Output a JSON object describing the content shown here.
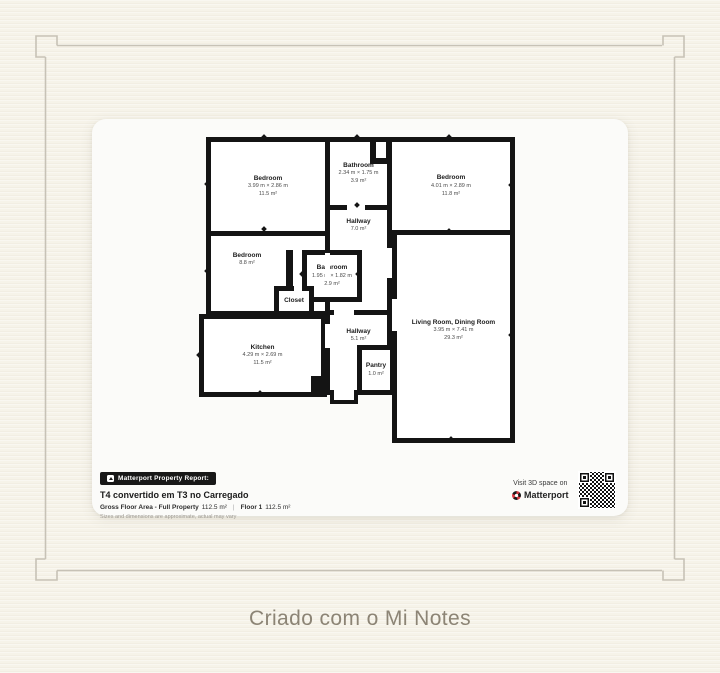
{
  "colors": {
    "background": "#f6f3e9",
    "card": "#fbfbf9",
    "wall": "#141414",
    "frame_line": "#c7c2b6",
    "matterport_red": "#d93a43",
    "footer_text": "#8c8475"
  },
  "floorplan": {
    "rooms": [
      {
        "id": "bedroom-tl",
        "name": "Bedroom",
        "dims": "3.99 m × 2.86 m",
        "area": "11.5 m²"
      },
      {
        "id": "bathroom-top",
        "name": "Bathroom",
        "dims": "2.34 m × 1.75 m",
        "area": "3.9 m²"
      },
      {
        "id": "bedroom-tr",
        "name": "Bedroom",
        "dims": "4.01 m × 2.89 m",
        "area": "11.8 m²"
      },
      {
        "id": "hallway-top",
        "name": "Hallway",
        "area": "7.0 m²"
      },
      {
        "id": "bedroom-left",
        "name": "Bedroom",
        "area": "8.8 m²"
      },
      {
        "id": "bathroom-mid",
        "name": "Bathroom",
        "dims": "1.95 m × 1.82 m",
        "area": "2.9 m²"
      },
      {
        "id": "closet",
        "name": "Closet"
      },
      {
        "id": "kitchen",
        "name": "Kitchen",
        "dims": "4.29 m × 2.69 m",
        "area": "11.5 m²"
      },
      {
        "id": "hallway-bottom",
        "name": "Hallway",
        "area": "5.1 m²"
      },
      {
        "id": "pantry",
        "name": "Pantry",
        "area": "1.0 m²"
      },
      {
        "id": "living",
        "name": "Living Room, Dining Room",
        "dims": "3.95 m × 7.41 m",
        "area": "29.3 m²"
      }
    ],
    "report": {
      "badge": "Matterport Property Report:",
      "title": "T4 convertido em T3 no Carregado",
      "gross_label": "Gross Floor Area - Full Property",
      "gross_value": "112.5 m²",
      "separator": "|",
      "floor_label": "Floor 1",
      "floor_value": "112.5 m²",
      "disclaimer": "Sizes and dimensions are approximate, actual may vary"
    },
    "visit": {
      "line1": "Visit 3D space on",
      "brand": "Matterport"
    }
  },
  "footer": {
    "caption": "Criado com o Mi Notes"
  }
}
